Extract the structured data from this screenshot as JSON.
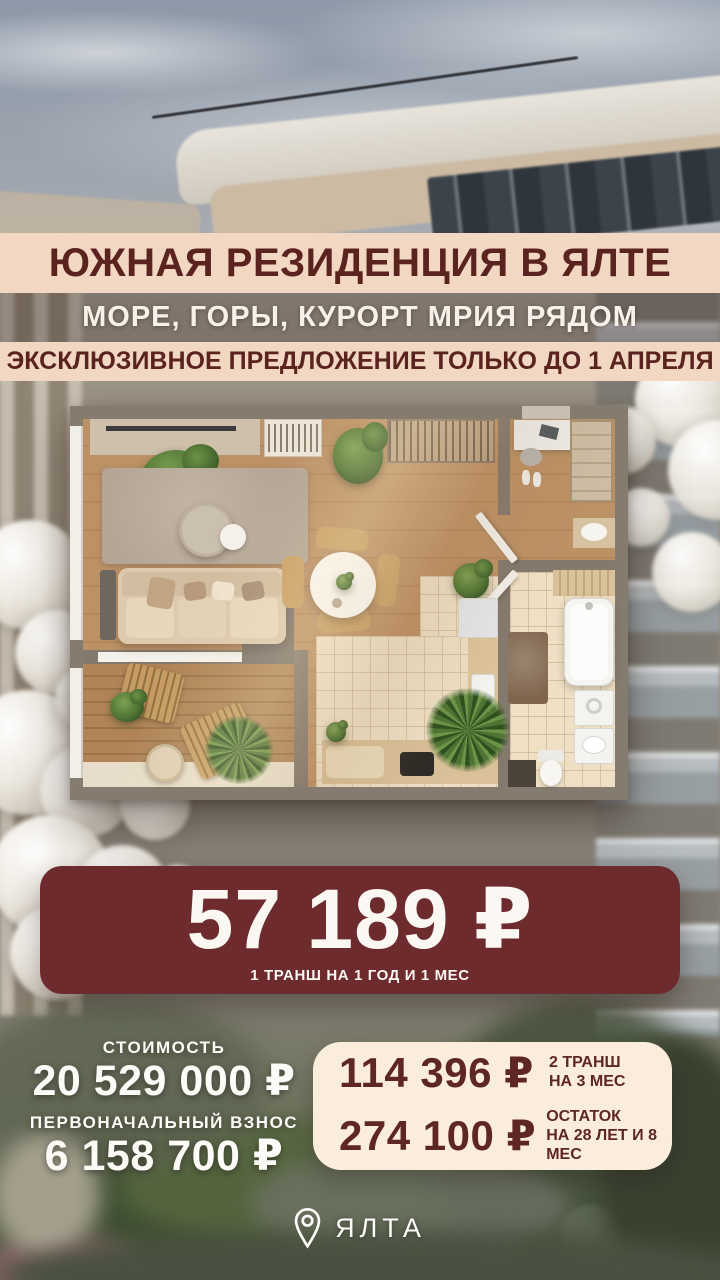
{
  "header": {
    "title": "ЮЖНАЯ РЕЗИДЕНЦИЯ В ЯЛТЕ",
    "subtitle": "МОРЕ, ГОРЫ, КУРОРТ МРИЯ РЯДОМ",
    "offer_note": "ЭКСКЛЮЗИВНОЕ ПРЕДЛОЖЕНИЕ ТОЛЬКО ДО 1 АПРЕЛЯ"
  },
  "price_banner": {
    "amount": "57 189 ₽",
    "note": "1 ТРАНШ НА 1 ГОД И 1 МЕС"
  },
  "pricing": {
    "cost_label": "СТОИМОСТЬ",
    "cost_value": "20 529 000 ₽",
    "downpayment_label": "ПЕРВОНАЧАЛЬНЫЙ ВЗНОС",
    "downpayment_value": "6 158 700 ₽"
  },
  "tranches": [
    {
      "amount": "114 396 ₽",
      "label_line1": "2 ТРАНШ",
      "label_line2": "НА 3 МЕС"
    },
    {
      "amount": "274 100 ₽",
      "label_line1": "ОСТАТОК",
      "label_line2": "НА 28 ЛЕТ И 8 МЕС"
    }
  ],
  "location": {
    "name": "ЯЛТА"
  },
  "colors": {
    "maroon_banner": "#6e2b2e",
    "maroon_text": "#5b2320",
    "cream_band": "#f2d7c3",
    "cream_card": "#fbeddc",
    "white_text": "#fdfbf8"
  }
}
